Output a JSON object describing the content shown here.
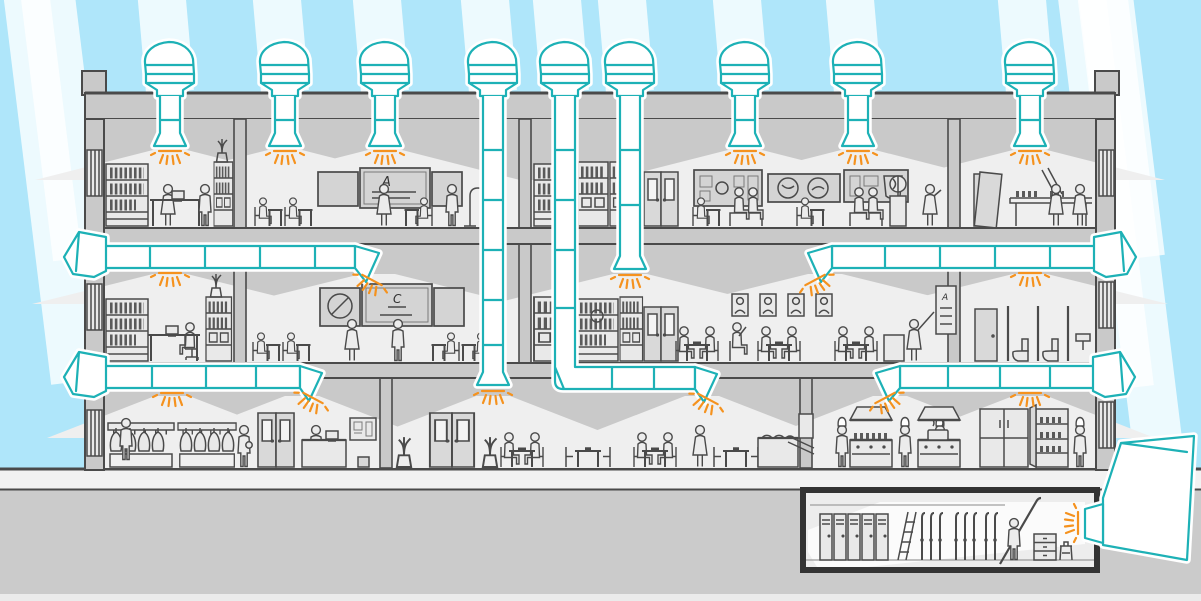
{
  "colors": {
    "sky": "#afe6fa",
    "beam": "rgba(255,255,255,0.78)",
    "line": "#4a4a4a",
    "wall": "#c9c9c9",
    "shade": "#c9c9c9",
    "room": "#efefef",
    "walkway": "#f2f2f2",
    "earth": "#cbcbcb",
    "teal": "#1db1b6",
    "orange": "#f5921e",
    "duct_fill": "#ffffff",
    "furniture_fill": "#e9e9e9",
    "board_fill": "#d4d4d4",
    "people_fill": "#ececec",
    "basement_wall": "#333333"
  },
  "text": {
    "blackboard_top_letter": "A",
    "blackboard_mid_letter": "C",
    "music_chart_letter": "A"
  },
  "scene": {
    "building": {
      "floors": [
        {
          "name": "top-floor",
          "rooms": [
            "library",
            "classroom",
            "storage-room",
            "exhibit-room",
            "plant-room"
          ]
        },
        {
          "name": "middle-floor",
          "rooms": [
            "office",
            "classroom",
            "storage-room",
            "music-room",
            "washroom"
          ]
        },
        {
          "name": "ground-floor",
          "rooms": [
            "cloakroom-lobby",
            "dining-hall",
            "kitchen"
          ]
        },
        {
          "name": "basement",
          "rooms": [
            "ski-storage"
          ]
        }
      ],
      "daylight_system": {
        "roof_collectors": 9,
        "wall_collectors": 5,
        "ceiling_diffusers": 17,
        "basement_diffusers": 1
      }
    }
  }
}
